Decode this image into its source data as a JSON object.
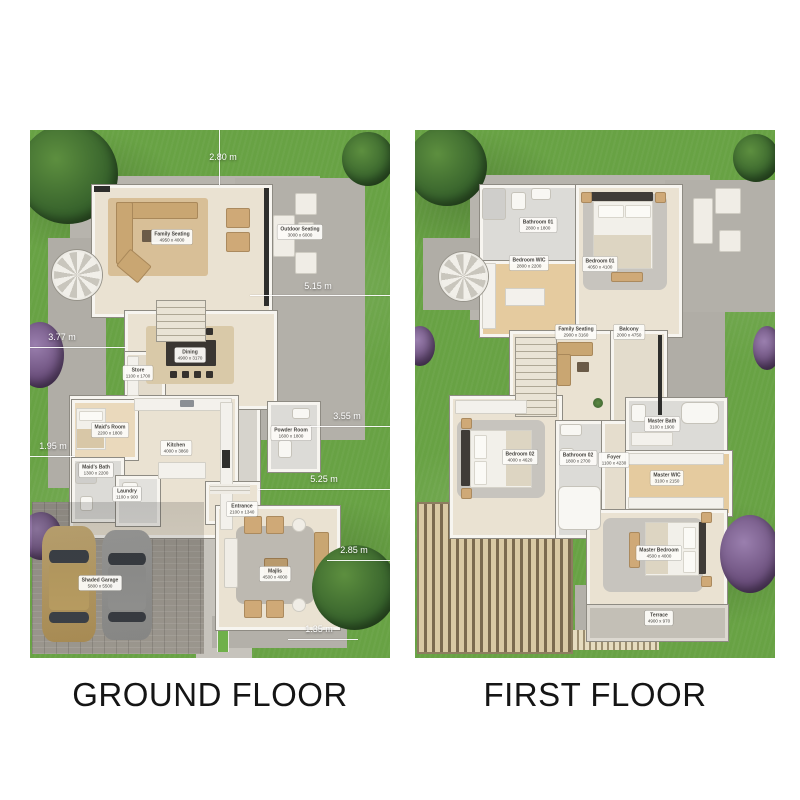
{
  "palette": {
    "grass": "#68a244",
    "pad": "#b7b4ad",
    "floor": "#eae2d2",
    "wood": "#e5cb9f",
    "label_bg": "#fcfbf8",
    "dim_text": "#ffffff",
    "title_color": "#151515"
  },
  "floors": [
    {
      "id": "ground-floor-plan",
      "title": "GROUND FLOOR",
      "rooms": [
        {
          "name": "Family Seating",
          "dims": "4950 x 4000",
          "x": 142,
          "y": 107
        },
        {
          "name": "Outdoor Seating",
          "dims": "3000 x 6000",
          "x": 270,
          "y": 102
        },
        {
          "name": "Dining",
          "dims": "4900 x 3170",
          "x": 160,
          "y": 225
        },
        {
          "name": "Store",
          "dims": "1100 x 1700",
          "x": 108,
          "y": 243
        },
        {
          "name": "Maid's Room",
          "dims": "2200 x 1800",
          "x": 80,
          "y": 300
        },
        {
          "name": "Maid's Bath",
          "dims": "1300 x 2200",
          "x": 66,
          "y": 340
        },
        {
          "name": "Laundry",
          "dims": "1100 x 900",
          "x": 97,
          "y": 364
        },
        {
          "name": "Kitchen",
          "dims": "4000 x 3860",
          "x": 146,
          "y": 318
        },
        {
          "name": "Powder Room",
          "dims": "1600 x 1800",
          "x": 261,
          "y": 303
        },
        {
          "name": "Entrance",
          "dims": "2100 x 1340",
          "x": 212,
          "y": 379
        },
        {
          "name": "Majlis",
          "dims": "4500 x 4000",
          "x": 245,
          "y": 444
        },
        {
          "name": "Shaded Garage",
          "dims": "5800 x 5500",
          "x": 70,
          "y": 453
        }
      ],
      "dimensions": [
        {
          "value": "2.80 m",
          "tx": 193,
          "ty": 27,
          "line": {
            "x": 189,
            "y": 0,
            "w": 1,
            "h": 55
          }
        },
        {
          "value": "5.15 m",
          "tx": 288,
          "ty": 156,
          "line": {
            "x": 220,
            "y": 165,
            "w": 140,
            "h": 1
          }
        },
        {
          "value": "3.77 m",
          "tx": 32,
          "ty": 207,
          "line": {
            "x": 0,
            "y": 217,
            "w": 96,
            "h": 1
          }
        },
        {
          "value": "3.55 m",
          "tx": 317,
          "ty": 286,
          "line": {
            "x": 280,
            "y": 296,
            "w": 80,
            "h": 1
          }
        },
        {
          "value": "1.95 m",
          "tx": 23,
          "ty": 316,
          "line": {
            "x": 0,
            "y": 326,
            "w": 45,
            "h": 1
          }
        },
        {
          "value": "5.25 m",
          "tx": 294,
          "ty": 349,
          "line": {
            "x": 228,
            "y": 359,
            "w": 132,
            "h": 1
          }
        },
        {
          "value": "2.85 m",
          "tx": 324,
          "ty": 420,
          "line": {
            "x": 297,
            "y": 430,
            "w": 63,
            "h": 1
          }
        },
        {
          "value": "1.35 m",
          "tx": 289,
          "ty": 499,
          "line": {
            "x": 258,
            "y": 509,
            "w": 70,
            "h": 1
          }
        }
      ]
    },
    {
      "id": "first-floor-plan",
      "title": "FIRST FLOOR",
      "rooms": [
        {
          "name": "Bathroom 01",
          "dims": "2800 x 1800",
          "x": 123,
          "y": 95
        },
        {
          "name": "Bedroom WIC",
          "dims": "2800 x 2200",
          "x": 114,
          "y": 133
        },
        {
          "name": "Bedroom 01",
          "dims": "4050 x 4100",
          "x": 185,
          "y": 134
        },
        {
          "name": "Family Seating",
          "dims": "2900 x 3160",
          "x": 161,
          "y": 202
        },
        {
          "name": "Balcony",
          "dims": "2000 x 4750",
          "x": 214,
          "y": 202
        },
        {
          "name": "Bedroom 02",
          "dims": "4000 x 4620",
          "x": 105,
          "y": 327
        },
        {
          "name": "Bathroom 02",
          "dims": "1800 x 2700",
          "x": 163,
          "y": 328
        },
        {
          "name": "Foyer",
          "dims": "1100 x 4230",
          "x": 199,
          "y": 330
        },
        {
          "name": "Master Bath",
          "dims": "3100 x 1900",
          "x": 247,
          "y": 294
        },
        {
          "name": "Master WIC",
          "dims": "3100 x 2150",
          "x": 252,
          "y": 348
        },
        {
          "name": "Master Bedroom",
          "dims": "4500 x 4000",
          "x": 244,
          "y": 423
        },
        {
          "name": "Terrace",
          "dims": "4900 x 970",
          "x": 244,
          "y": 488
        }
      ],
      "dimensions": []
    }
  ]
}
